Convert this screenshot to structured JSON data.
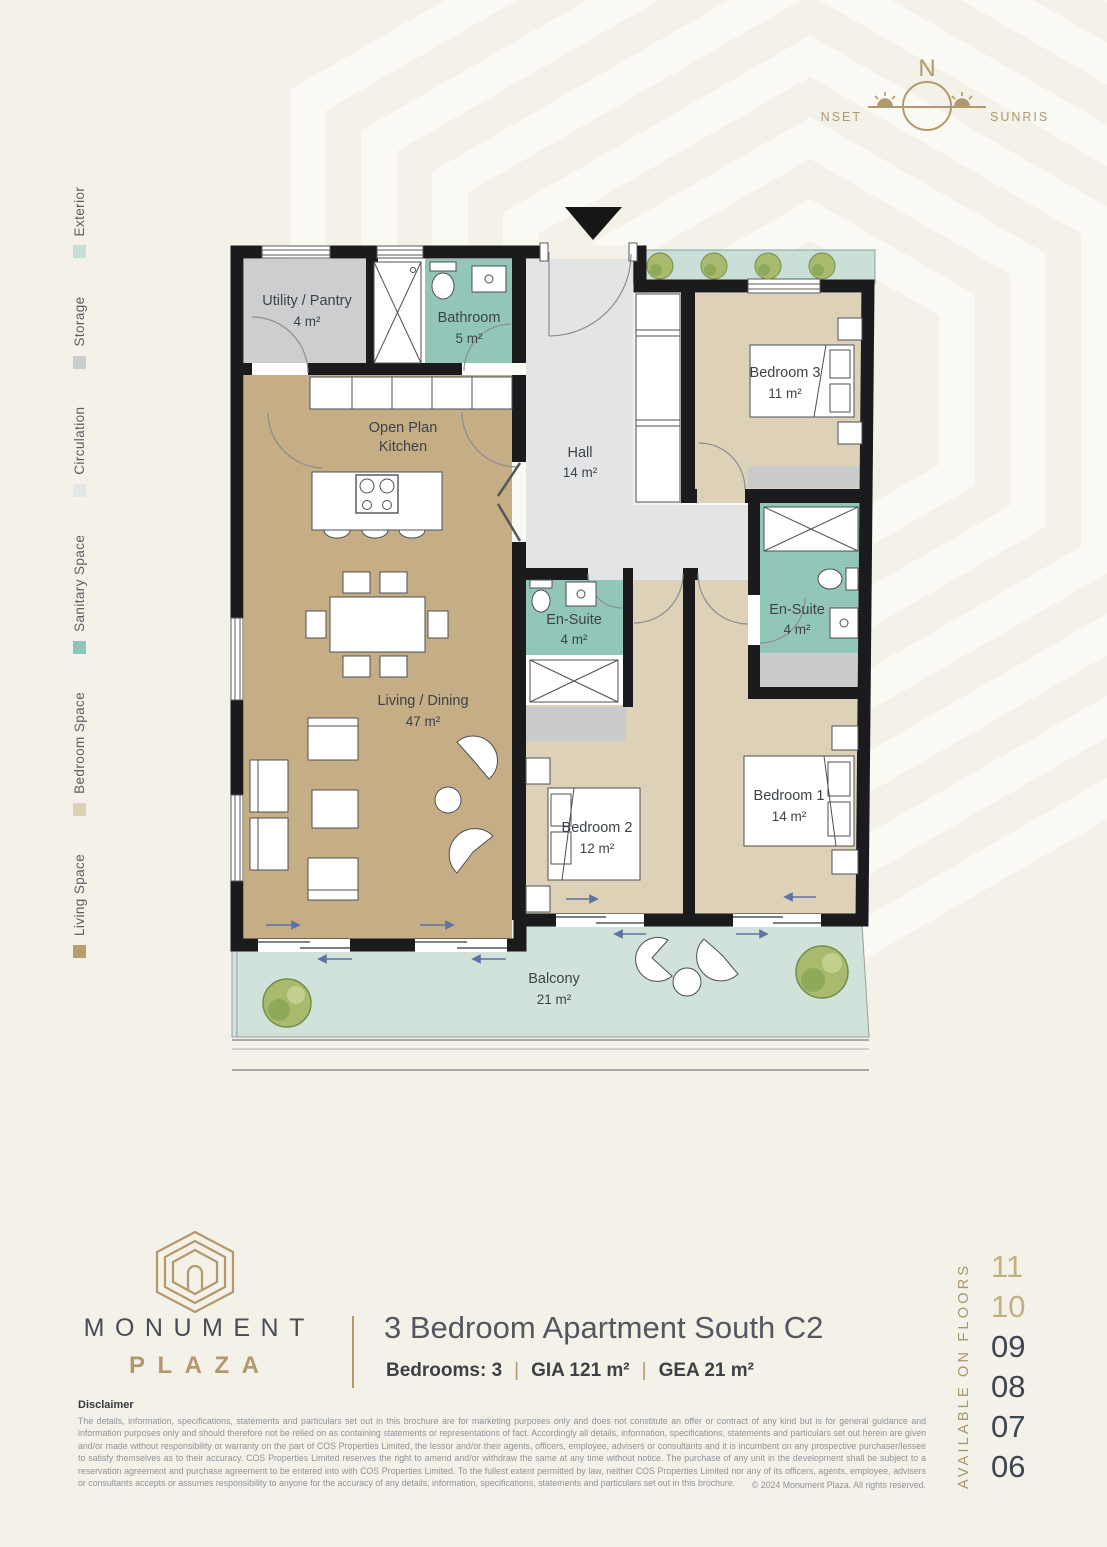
{
  "compass": {
    "north_label": "N",
    "sunset_label": "SUNSET",
    "sunrise_label": "SUNRISE"
  },
  "legend": {
    "items": [
      {
        "label": "Living Space",
        "color": "#b89d6d"
      },
      {
        "label": "Bedroom Space",
        "color": "#ddd1b4"
      },
      {
        "label": "Sanitary Space",
        "color": "#8ec4b6"
      },
      {
        "label": "Circulation",
        "color": "#e4e6e8"
      },
      {
        "label": "Storage",
        "color": "#cbcdcf"
      },
      {
        "label": "Exterior",
        "color": "#c6ded7"
      }
    ]
  },
  "floorplan": {
    "rooms": [
      {
        "name": "Utility / Pantry",
        "area": "4 m²"
      },
      {
        "name": "Bathroom",
        "area": "5 m²"
      },
      {
        "name": "Open Plan",
        "name2": "Kitchen"
      },
      {
        "name": "Hall",
        "area": "14 m²"
      },
      {
        "name": "Bedroom 3",
        "area": "11 m²"
      },
      {
        "name": "En-Suite",
        "area": "4 m²"
      },
      {
        "name": "En-Suite",
        "area": "4 m²"
      },
      {
        "name": "Living / Dining",
        "area": "47 m²"
      },
      {
        "name": "Bedroom 2",
        "area": "12 m²"
      },
      {
        "name": "Bedroom 1",
        "area": "14 m²"
      },
      {
        "name": "Balcony",
        "area": "21 m²"
      }
    ],
    "colors": {
      "living": "#c5ad85",
      "bedroom": "#ddd2b8",
      "sanitary": "#92c6b9",
      "circulation": "#e3e4e5",
      "storage": "#cdced0",
      "exterior": "#d0e2da",
      "wall": "#1b1b1d"
    }
  },
  "footer": {
    "brand_line1": "MONUMENT",
    "brand_line2": "PLAZA",
    "title": "3 Bedroom Apartment South C2",
    "specs": {
      "bedrooms": "Bedrooms: 3",
      "gia": "GIA 121 m²",
      "gea": "GEA 21 m²",
      "sep": "|"
    }
  },
  "disclaimer": {
    "heading": "Disclaimer",
    "body": "The details, information, specifications, statements and particulars set out in this brochure are for marketing purposes only and does not constitute an offer or contract of any kind but is for general guidance and information purposes only and should therefore not be relied on as containing statements or representations of fact. Accordingly all details, information, specifications, statements and particulars set out herein are given and/or made without responsibility or warranty on the part of COS Properties Limited, the lessor and/or their agents, officers, employee, advisers or consultants and it is incumbent on any prospective purchaser/lessee to satisfy themselves as to their accuracy. COS Properties Limited reserves the right to amend and/or withdraw the same at any time without notice. The purchase of any unit in the development shall be subject to a reservation agreement and purchase agreement to be entered into with COS Properties Limited. To the fullest extent permitted by law, neither COS Properties Limited nor any of its officers, agents, employee, advisers or consultants accepts or assumes responsibility to anyone for the accuracy of any details, information, specifications, statements and particulars set out in this brochure.",
    "copyright": "© 2024  Monument Plaza. All rights reserved."
  },
  "availability": {
    "label": "AVAILABLE ON FLOORS",
    "floors": [
      {
        "number": "11",
        "muted": true
      },
      {
        "number": "10",
        "muted": true
      },
      {
        "number": "09",
        "muted": false
      },
      {
        "number": "08",
        "muted": false
      },
      {
        "number": "07",
        "muted": false
      },
      {
        "number": "06",
        "muted": false
      }
    ]
  }
}
